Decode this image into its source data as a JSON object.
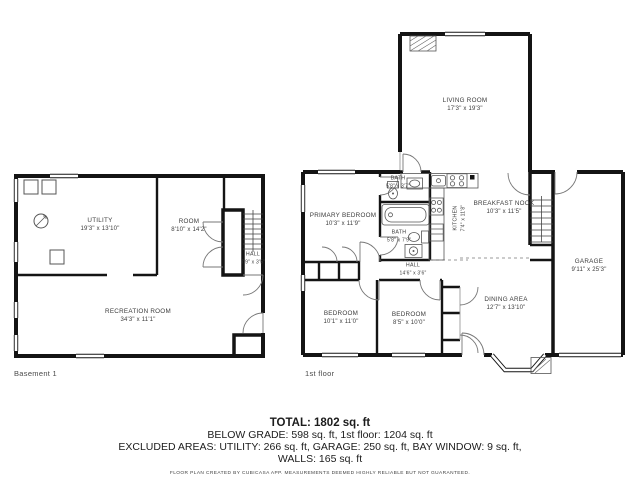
{
  "document": {
    "type": "floor-plan",
    "background": "#ffffff",
    "wall_color": "#141414",
    "text_color": "#3b3b3b"
  },
  "basement": {
    "label": "Basement 1",
    "rooms": [
      {
        "name": "UTILITY",
        "dims": "19'3\" x 13'10\""
      },
      {
        "name": "ROOM",
        "dims": "8'10\" x 14'2\""
      },
      {
        "name": "HALL",
        "dims": "7'9\" x 3'5\""
      },
      {
        "name": "RECREATION ROOM",
        "dims": "34'3\" x 11'1\""
      }
    ]
  },
  "first_floor": {
    "label": "1st floor",
    "rooms": [
      {
        "name": "LIVING ROOM",
        "dims": "17'3\" x 19'3\""
      },
      {
        "name": "PRIMARY BEDROOM",
        "dims": "10'3\" x 11'9\""
      },
      {
        "name": "BATH",
        "dims": "5'8\" x 3'7\""
      },
      {
        "name": "BATH",
        "dims": "5'8\" x 7'9\""
      },
      {
        "name": "KITCHEN",
        "dims": "7'4\" x 11'8\""
      },
      {
        "name": "BREAKFAST NOOK",
        "dims": "10'3\" x 11'5\""
      },
      {
        "name": "HALL",
        "dims": "14'6\" x 3'6\""
      },
      {
        "name": "BEDROOM",
        "dims": "10'1\" x 11'0\""
      },
      {
        "name": "BEDROOM",
        "dims": "8'5\" x 10'0\""
      },
      {
        "name": "DINING AREA",
        "dims": "12'7\" x 13'10\""
      },
      {
        "name": "GARAGE",
        "dims": "9'11\" x 25'3\""
      }
    ]
  },
  "footer": {
    "total": "TOTAL: 1802 sq. ft",
    "line2": "BELOW GRADE: 598 sq. ft, 1st floor: 1204 sq. ft",
    "line3": "EXCLUDED AREAS: UTILITY: 266 sq. ft, GARAGE: 250 sq. ft, BAY WINDOW: 9 sq. ft,",
    "line4": "WALLS: 165 sq. ft",
    "credit": "FLOOR PLAN CREATED BY CUBICASA APP. MEASUREMENTS DEEMED HIGHLY RELIABLE BUT NOT GUARANTEED."
  }
}
